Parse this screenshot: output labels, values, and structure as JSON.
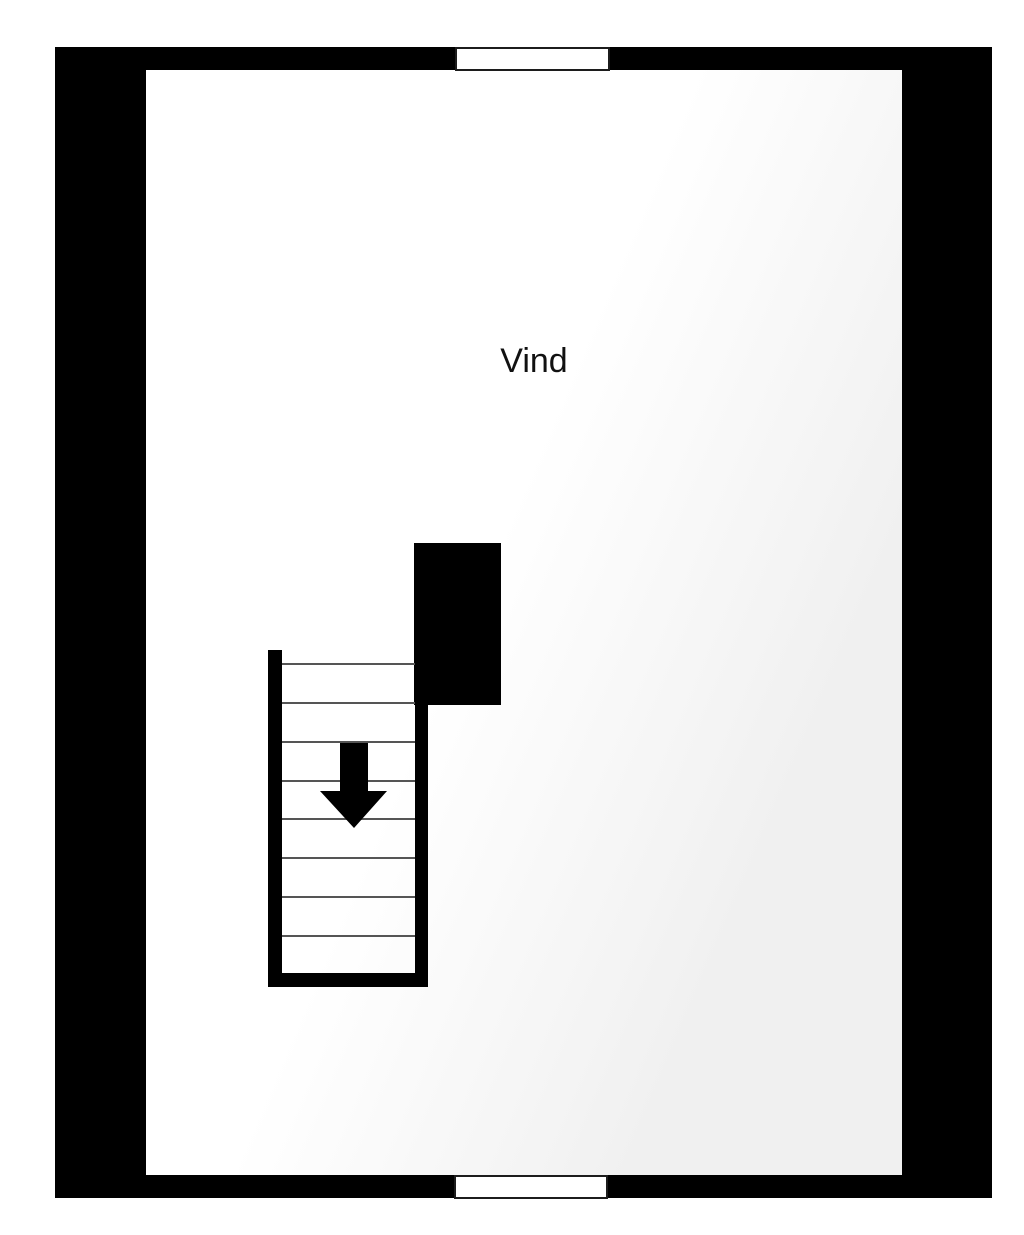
{
  "floorplan": {
    "room": {
      "label": "Vind"
    },
    "stairs": {
      "tread_count": 8,
      "arrow_direction": "down"
    },
    "windows": {
      "positions": [
        "top",
        "bottom"
      ]
    },
    "colors": {
      "wall": "#000000",
      "shade": "#f0f0f0",
      "tread_line": "#555555",
      "label": "#111111",
      "window_fill": "#ffffff",
      "window_border": "#1c1c1c"
    }
  }
}
